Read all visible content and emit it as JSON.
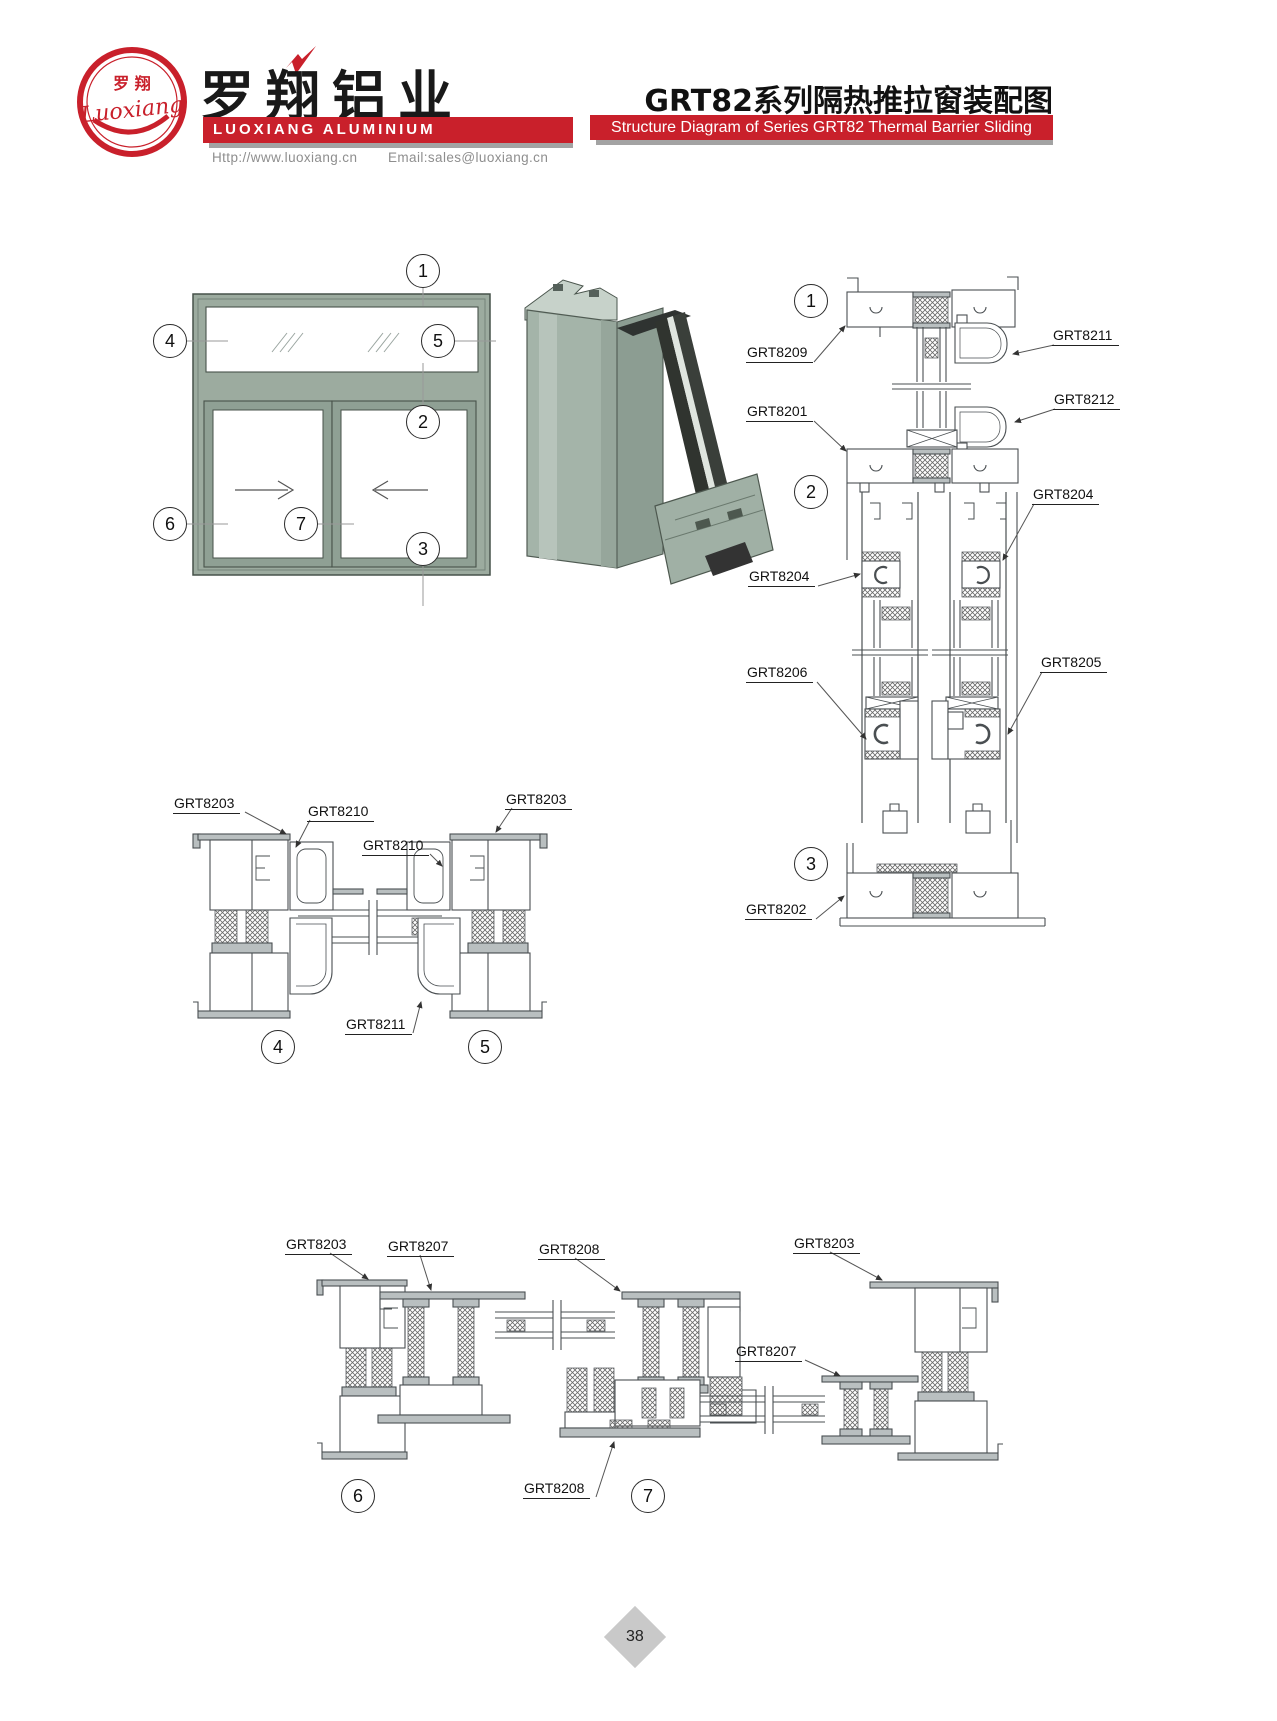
{
  "header": {
    "logo": {
      "zh": "罗 翔",
      "script": "Luoxiang"
    },
    "company_zh": "罗翔铝业",
    "company_en": "LUOXIANG ALUMINIUM",
    "website": "Http://www.luoxiang.cn",
    "email": "Email:sales@luoxiang.cn",
    "title_zh": "GRT82系列隔热推拉窗装配图",
    "title_en": "Structure Diagram of Series GRT82 Thermal Barrier Sliding Window"
  },
  "colors": {
    "accent_red": "#c9202b",
    "frame_green": "#9cab9f",
    "line": "#4a4f52"
  },
  "elevation": {
    "markers": [
      "1",
      "2",
      "3",
      "4",
      "5",
      "6",
      "7"
    ]
  },
  "vertical_section": {
    "markers": [
      "1",
      "2",
      "3"
    ],
    "labels": [
      "GRT8209",
      "GRT8211",
      "GRT8201",
      "GRT8212",
      "GRT8204",
      "GRT8204",
      "GRT8206",
      "GRT8205",
      "GRT8202"
    ]
  },
  "section_45": {
    "markers": [
      "4",
      "5"
    ],
    "labels": [
      "GRT8203",
      "GRT8210",
      "GRT8210",
      "GRT8203",
      "GRT8211"
    ]
  },
  "section_67": {
    "markers": [
      "6",
      "7"
    ],
    "labels": [
      "GRT8203",
      "GRT8207",
      "GRT8208",
      "GRT8203",
      "GRT8207",
      "GRT8208"
    ]
  },
  "footer": {
    "page_number": "38"
  }
}
